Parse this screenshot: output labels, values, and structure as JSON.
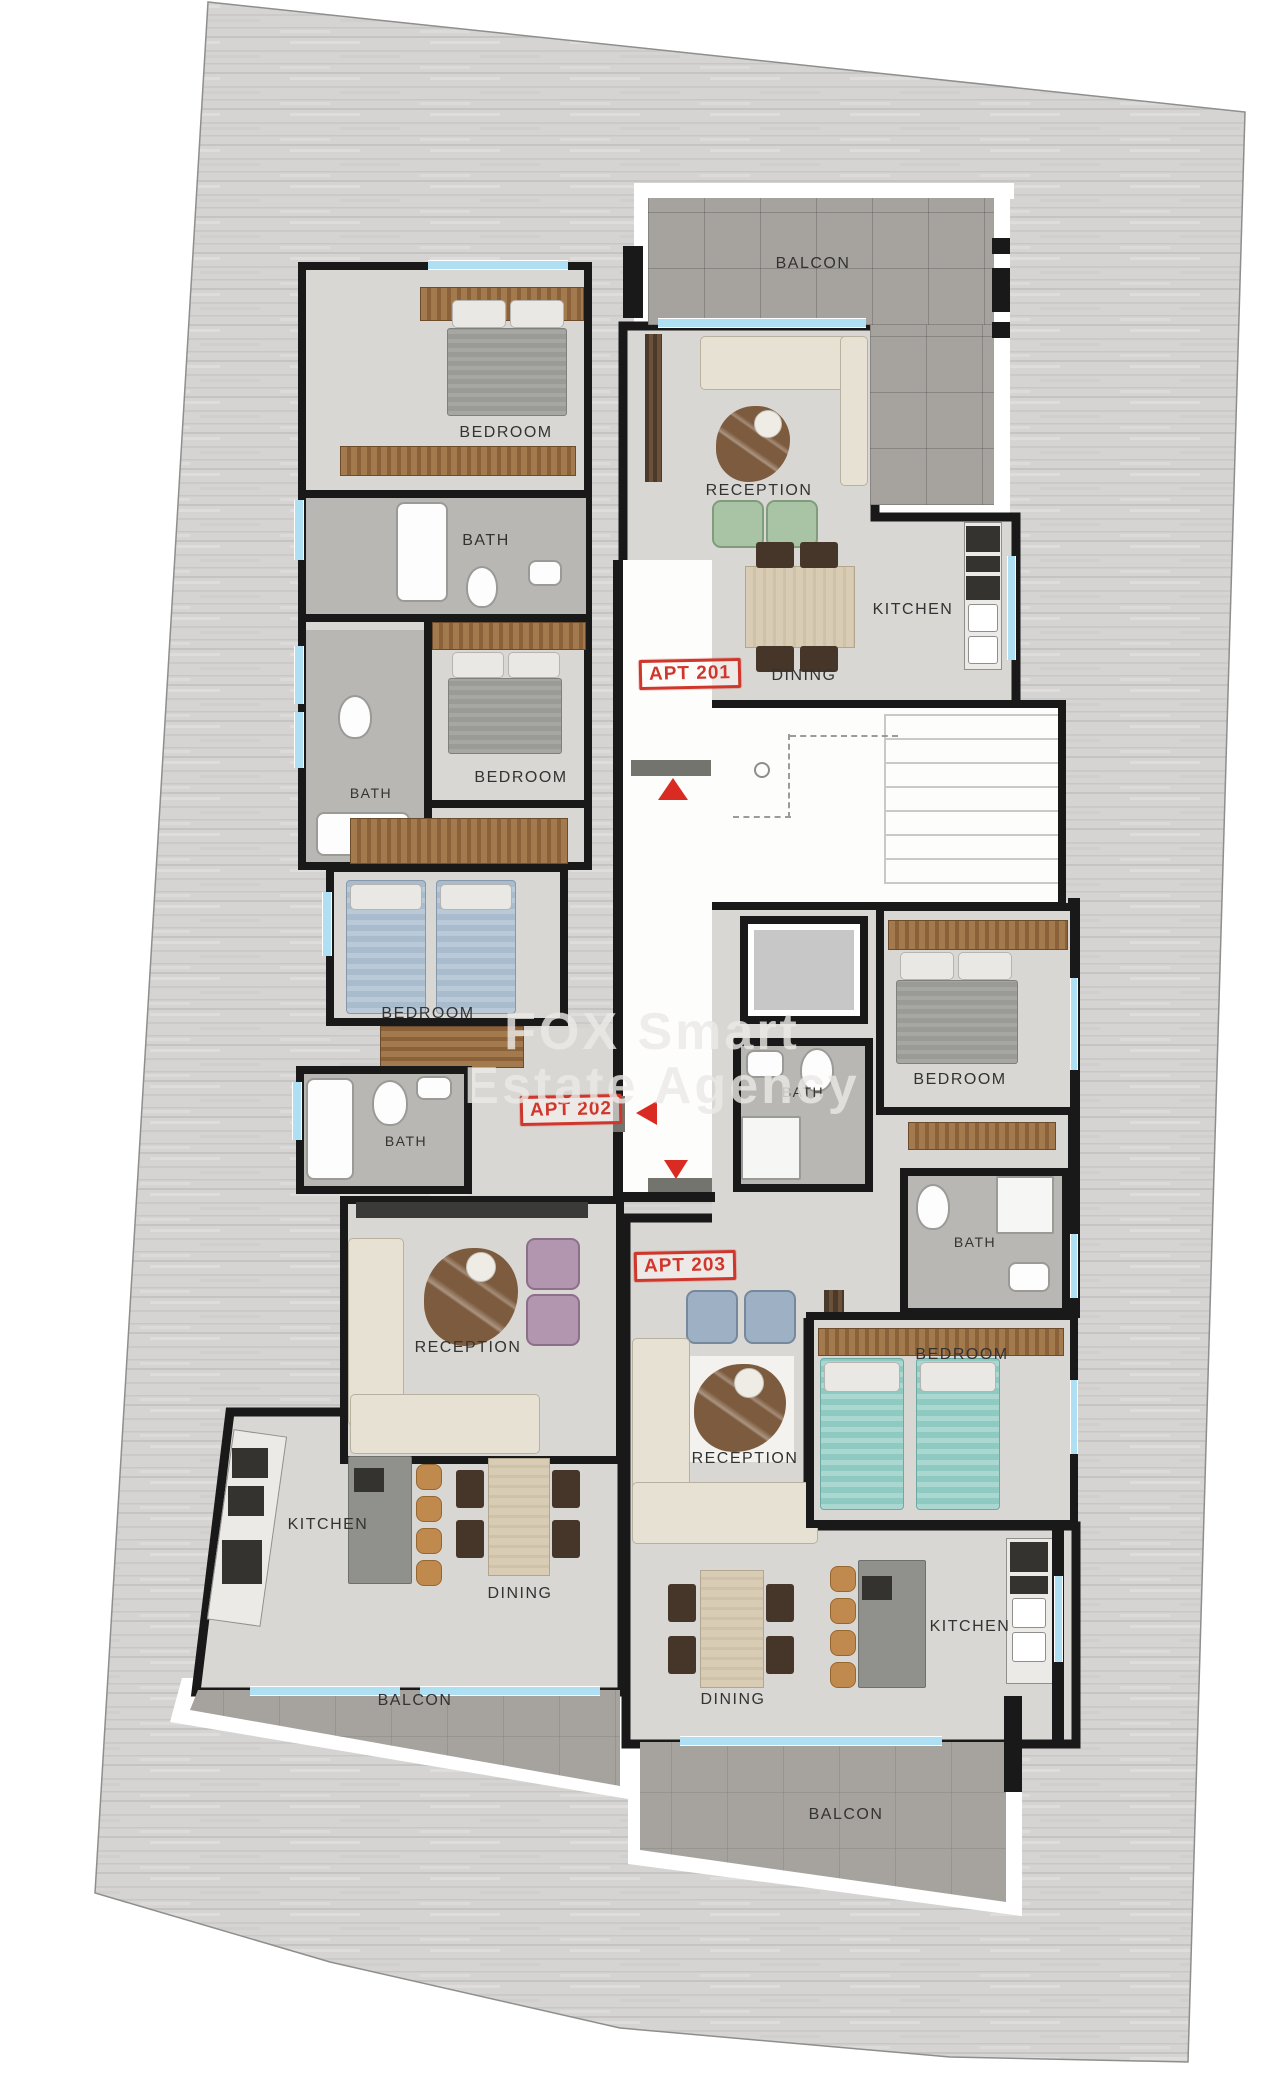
{
  "watermark": {
    "line1": "FOX Smart",
    "line2": "Estate Agency"
  },
  "apt_tags": [
    {
      "text": "APT 201"
    },
    {
      "text": "APT 202"
    },
    {
      "text": "APT 203"
    }
  ],
  "labels": [
    {
      "text": "BALCON",
      "apt": "APT 201"
    },
    {
      "text": "BEDROOM",
      "apt": "APT 201"
    },
    {
      "text": "RECEPTION",
      "apt": "APT 201"
    },
    {
      "text": "BATH",
      "apt": "APT 201"
    },
    {
      "text": "KITCHEN",
      "apt": "APT 201"
    },
    {
      "text": "DINING",
      "apt": "APT 201"
    },
    {
      "text": "BEDROOM",
      "apt": "APT 201"
    },
    {
      "text": "BATH",
      "apt": "APT 202"
    },
    {
      "text": "BEDROOM",
      "apt": "APT 202"
    },
    {
      "text": "BEDROOM",
      "apt": "APT 203"
    },
    {
      "text": "BATH",
      "apt": "APT 203"
    },
    {
      "text": "BATH",
      "apt": "APT 202"
    },
    {
      "text": "BATH",
      "apt": "APT 203"
    },
    {
      "text": "RECEPTION",
      "apt": "APT 202"
    },
    {
      "text": "BEDROOM",
      "apt": "APT 203"
    },
    {
      "text": "RECEPTION",
      "apt": "APT 203"
    },
    {
      "text": "KITCHEN",
      "apt": "APT 202"
    },
    {
      "text": "DINING",
      "apt": "APT 202"
    },
    {
      "text": "KITCHEN",
      "apt": "APT 203"
    },
    {
      "text": "DINING",
      "apt": "APT 203"
    },
    {
      "text": "BALCON",
      "apt": "APT 202"
    },
    {
      "text": "BALCON",
      "apt": "APT 203"
    }
  ],
  "entry_arrows": [
    {
      "direction": "up",
      "apartment": "APT 201"
    },
    {
      "direction": "left",
      "apartment": "APT 202"
    },
    {
      "direction": "down",
      "apartment": "APT 203"
    }
  ],
  "colors": {
    "wall": "#191919",
    "window": "#aedff2",
    "room_floor": "#d9d7d4",
    "bath_floor": "#b9b7b3",
    "balcony_tile": "#a6a29d",
    "deck_wood": "#d5d4d2",
    "corridor": "#fdfdfc",
    "accent_red": "#d0372c",
    "furniture_wood": "#8a6138"
  }
}
